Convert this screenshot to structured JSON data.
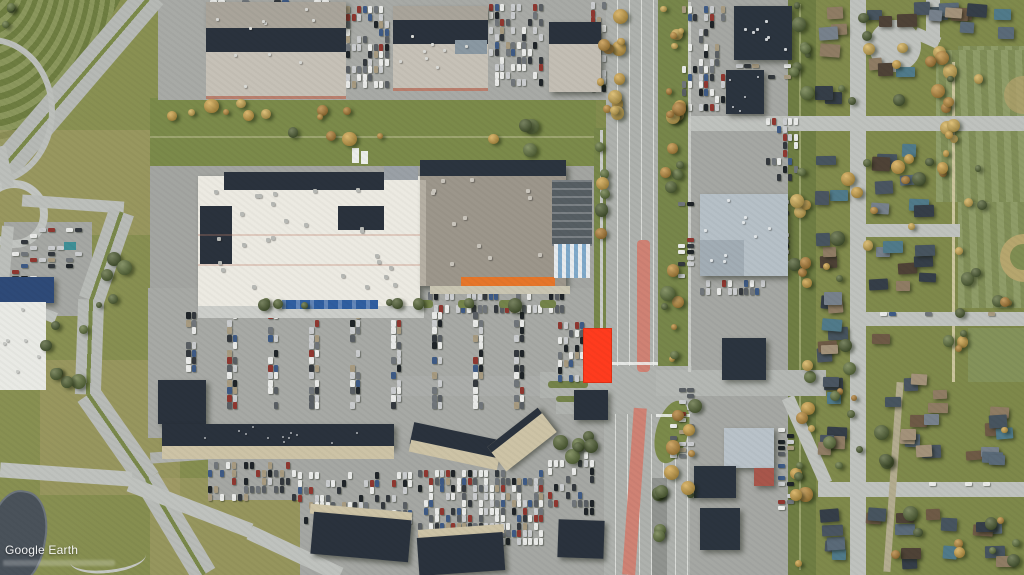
{
  "meta": {
    "view": "aerial satellite imagery of a suburban shopping centre, divided highway and residential neighbourhood",
    "width": 1024,
    "height": 575
  },
  "watermark": {
    "text": "Google Earth"
  },
  "highlight": {
    "label": "highlighted parcel for sale",
    "color": "#ff3b1e",
    "x": 583,
    "y": 328,
    "width": 29,
    "height": 55
  },
  "palette": {
    "highlight_red": "#ff3b1e",
    "storefront_orange": "#e6762a",
    "entrance_awning_blue": "#2f5ea0",
    "red_transit_median": "#cf8274",
    "pond_water": "#4a525a",
    "grass_green": "#87904f",
    "park_green": "#87955c",
    "navy_roof": "#2a323d",
    "white_roof": "#e9eae5",
    "gray_roof": "#9c968b",
    "road_gray": "#bfc2be",
    "highway_gray": "#aeb1ad"
  },
  "scene": {
    "seed": 987654321,
    "car_colors": [
      "#e9eae8",
      "#e9eae8",
      "#e9eae8",
      "#caccce",
      "#caccce",
      "#595e63",
      "#33383d",
      "#1f2428",
      "#8f3730",
      "#3e5a85",
      "#a79a80",
      "#70757a"
    ],
    "roof_colors": [
      "#353e48",
      "#4a5561",
      "#5a6a78",
      "#77818c",
      "#6e5a46",
      "#8f7c64",
      "#4e4236",
      "#a3927a",
      "#47545f",
      "#507a8a"
    ],
    "tree_green": [
      "#3f4e28",
      "#49592d",
      "#566835"
    ],
    "tree_fall": [
      "#bc8434",
      "#cf9c3f",
      "#ae742c",
      "#d2a84e"
    ],
    "car_zones": [
      {
        "x": 346,
        "y": 6,
        "w": 44,
        "h": 86,
        "cw": 4,
        "ch": 7,
        "sx": 5.5,
        "sy": 7.5,
        "occ": 0.6
      },
      {
        "x": 489,
        "y": 4,
        "w": 58,
        "h": 88,
        "cw": 4,
        "ch": 7,
        "sx": 5.5,
        "sy": 7.5,
        "occ": 0.55
      },
      {
        "x": 210,
        "y": 0,
        "w": 128,
        "h": 20,
        "cw": 7,
        "ch": 4,
        "sx": 8,
        "sy": 5.5,
        "occ": 0.4
      },
      {
        "x": 591,
        "y": 2,
        "w": 15,
        "h": 90,
        "cw": 4,
        "ch": 7,
        "sx": 5.5,
        "sy": 7.5,
        "occ": 0.5
      },
      {
        "x": 682,
        "y": 6,
        "w": 46,
        "h": 108,
        "cw": 4,
        "ch": 7,
        "sx": 5.5,
        "sy": 7.5,
        "occ": 0.5
      },
      {
        "x": 766,
        "y": 118,
        "w": 32,
        "h": 64,
        "cw": 4,
        "ch": 7,
        "sx": 5.5,
        "sy": 8,
        "occ": 0.45
      },
      {
        "x": 736,
        "y": 64,
        "w": 60,
        "h": 18,
        "cw": 7,
        "ch": 4,
        "sx": 8,
        "sy": 5.5,
        "occ": 0.35
      },
      {
        "x": 700,
        "y": 280,
        "w": 66,
        "h": 22,
        "cw": 4,
        "ch": 7,
        "sx": 5.5,
        "sy": 8,
        "occ": 0.6
      },
      {
        "x": 766,
        "y": 200,
        "w": 26,
        "h": 66,
        "cw": 7,
        "ch": 4,
        "sx": 8,
        "sy": 5.5,
        "occ": 0.5
      },
      {
        "x": 678,
        "y": 196,
        "w": 18,
        "h": 84,
        "cw": 7,
        "ch": 4,
        "sx": 9,
        "sy": 6,
        "occ": 0.45
      },
      {
        "x": 670,
        "y": 388,
        "w": 26,
        "h": 76,
        "cw": 7,
        "ch": 4,
        "sx": 8.5,
        "sy": 6,
        "occ": 0.45
      },
      {
        "x": 778,
        "y": 428,
        "w": 22,
        "h": 92,
        "cw": 7,
        "ch": 4,
        "sx": 8.5,
        "sy": 6,
        "occ": 0.4
      },
      {
        "x": 428,
        "y": 292,
        "w": 146,
        "h": 11,
        "cw": 4,
        "ch": 8,
        "sx": 5.5,
        "sy": 9,
        "occ": 0.7
      },
      {
        "x": 428,
        "y": 305,
        "w": 168,
        "h": 11,
        "cw": 4,
        "ch": 8,
        "sx": 5.5,
        "sy": 9,
        "occ": 0.6
      },
      {
        "x": 558,
        "y": 322,
        "w": 28,
        "h": 62,
        "cw": 4,
        "ch": 7,
        "sx": 5.5,
        "sy": 7.5,
        "occ": 0.55
      },
      {
        "x": 298,
        "y": 472,
        "w": 116,
        "h": 58,
        "cw": 4,
        "ch": 7,
        "sx": 5.5,
        "sy": 7.5,
        "occ": 0.5
      },
      {
        "x": 418,
        "y": 470,
        "w": 126,
        "h": 76,
        "cw": 4,
        "ch": 7,
        "sx": 5.5,
        "sy": 7.5,
        "occ": 0.65
      },
      {
        "x": 548,
        "y": 452,
        "w": 46,
        "h": 64,
        "cw": 4,
        "ch": 7,
        "sx": 6,
        "sy": 8,
        "occ": 0.4
      },
      {
        "x": 208,
        "y": 462,
        "w": 88,
        "h": 46,
        "cw": 4,
        "ch": 7,
        "sx": 6,
        "sy": 8,
        "occ": 0.35
      },
      {
        "x": 12,
        "y": 228,
        "w": 76,
        "h": 56,
        "cw": 7,
        "ch": 4,
        "sx": 9,
        "sy": 6,
        "occ": 0.3
      },
      {
        "x": 880,
        "y": 312,
        "w": 120,
        "h": 8,
        "cw": 7,
        "ch": 4,
        "sx": 9,
        "sy": 5,
        "occ": 0.3
      },
      {
        "x": 884,
        "y": 482,
        "w": 130,
        "h": 8,
        "cw": 7,
        "ch": 4,
        "sx": 9,
        "sy": 5,
        "occ": 0.25
      }
    ],
    "lot_columns": {
      "x0": 186,
      "pitch": 41,
      "pairs": 9,
      "y": 312,
      "h": 104,
      "gap": 5.5,
      "sy": 7.5,
      "cw": 4.5,
      "ch": 7,
      "occ": 0.72
    },
    "house_zones": [
      {
        "x": 813,
        "y": 2,
        "w": 36,
        "h": 108,
        "n": 6
      },
      {
        "x": 864,
        "y": 0,
        "w": 96,
        "h": 32,
        "n": 7
      },
      {
        "x": 940,
        "y": 2,
        "w": 82,
        "h": 46,
        "n": 7
      },
      {
        "x": 866,
        "y": 56,
        "w": 54,
        "h": 22,
        "n": 3
      },
      {
        "x": 814,
        "y": 138,
        "w": 34,
        "h": 334,
        "n": 21
      },
      {
        "x": 868,
        "y": 138,
        "w": 76,
        "h": 80,
        "n": 8
      },
      {
        "x": 868,
        "y": 240,
        "w": 84,
        "h": 66,
        "n": 8
      },
      {
        "x": 868,
        "y": 330,
        "w": 86,
        "h": 146,
        "n": 13
      },
      {
        "x": 958,
        "y": 384,
        "w": 62,
        "h": 90,
        "n": 8
      },
      {
        "x": 866,
        "y": 500,
        "w": 154,
        "h": 70,
        "n": 14
      },
      {
        "x": 816,
        "y": 500,
        "w": 32,
        "h": 70,
        "n": 5
      }
    ],
    "tree_zones": [
      {
        "x": 160,
        "y": 96,
        "w": 200,
        "h": 26,
        "n": 10,
        "pal": "fall"
      },
      {
        "x": 596,
        "y": 0,
        "w": 38,
        "h": 130,
        "n": 12,
        "pal": "fall"
      },
      {
        "x": 660,
        "y": 0,
        "w": 30,
        "h": 132,
        "n": 12,
        "pal": "fall"
      },
      {
        "x": 660,
        "y": 140,
        "w": 28,
        "h": 230,
        "n": 12,
        "pal": "mix"
      },
      {
        "x": 788,
        "y": 0,
        "w": 28,
        "h": 118,
        "n": 8,
        "pal": "mix"
      },
      {
        "x": 788,
        "y": 136,
        "w": 28,
        "h": 260,
        "n": 10,
        "pal": "mix"
      },
      {
        "x": 790,
        "y": 400,
        "w": 26,
        "h": 170,
        "n": 9,
        "pal": "mix"
      },
      {
        "x": 936,
        "y": 56,
        "w": 26,
        "h": 140,
        "n": 9,
        "pal": "fall"
      },
      {
        "x": 954,
        "y": 196,
        "w": 20,
        "h": 180,
        "n": 6,
        "pal": "mix"
      },
      {
        "x": 818,
        "y": 0,
        "w": 200,
        "h": 110,
        "n": 14,
        "pal": "mix"
      },
      {
        "x": 818,
        "y": 140,
        "w": 60,
        "h": 330,
        "n": 16,
        "pal": "mix"
      },
      {
        "x": 870,
        "y": 140,
        "w": 150,
        "h": 330,
        "n": 20,
        "pal": "mix"
      },
      {
        "x": 866,
        "y": 500,
        "w": 156,
        "h": 70,
        "n": 10,
        "pal": "mix"
      },
      {
        "x": 40,
        "y": 320,
        "w": 50,
        "h": 70,
        "n": 7,
        "pal": "green"
      },
      {
        "x": 552,
        "y": 425,
        "w": 56,
        "h": 40,
        "n": 6,
        "pal": "green"
      },
      {
        "x": 660,
        "y": 398,
        "w": 44,
        "h": 130,
        "n": 8,
        "pal": "mix"
      },
      {
        "x": 594,
        "y": 140,
        "w": 16,
        "h": 110,
        "n": 6,
        "pal": "mix"
      },
      {
        "x": 240,
        "y": 118,
        "w": 330,
        "h": 40,
        "n": 8,
        "pal": "mix"
      },
      {
        "x": 652,
        "y": 480,
        "w": 16,
        "h": 92,
        "n": 6,
        "pal": "green"
      },
      {
        "x": 0,
        "y": 0,
        "w": 22,
        "h": 34,
        "n": 3,
        "pal": "green"
      },
      {
        "x": 96,
        "y": 240,
        "w": 40,
        "h": 80,
        "n": 5,
        "pal": "green"
      },
      {
        "x": 188,
        "y": 298,
        "w": 360,
        "h": 12,
        "n": 9,
        "pal": "green"
      }
    ],
    "dot_zones": [
      {
        "x": 205,
        "y": 185,
        "w": 205,
        "h": 108,
        "n": 26,
        "c": "#b7b9b5",
        "s": 4
      },
      {
        "x": 428,
        "y": 172,
        "w": 120,
        "h": 98,
        "n": 12,
        "c": "#c9c5bc",
        "s": 4
      },
      {
        "x": 210,
        "y": 6,
        "w": 130,
        "h": 88,
        "n": 10,
        "c": "#d8d9d5",
        "s": 3
      },
      {
        "x": 396,
        "y": 12,
        "w": 88,
        "h": 76,
        "n": 8,
        "c": "#d8d9d5",
        "s": 3
      },
      {
        "x": 702,
        "y": 198,
        "w": 80,
        "h": 70,
        "n": 9,
        "c": "#e2e6e8",
        "s": 3
      },
      {
        "x": 736,
        "y": 8,
        "w": 52,
        "h": 46,
        "n": 7,
        "c": "#ced2d5",
        "s": 3
      },
      {
        "x": 165,
        "y": 426,
        "w": 222,
        "h": 18,
        "n": 12,
        "c": "#aeb2b6",
        "s": 2
      },
      {
        "x": 2,
        "y": 306,
        "w": 40,
        "h": 78,
        "n": 6,
        "c": "#c6c8c4",
        "s": 3
      },
      {
        "x": 724,
        "y": 72,
        "w": 36,
        "h": 40,
        "n": 5,
        "c": "#cfd3d6",
        "s": 2
      }
    ],
    "street_islands": {
      "y": 300,
      "h": 8,
      "w": 16,
      "xs": [
        212,
        253,
        294,
        335,
        376,
        417,
        458,
        499,
        540
      ]
    }
  }
}
